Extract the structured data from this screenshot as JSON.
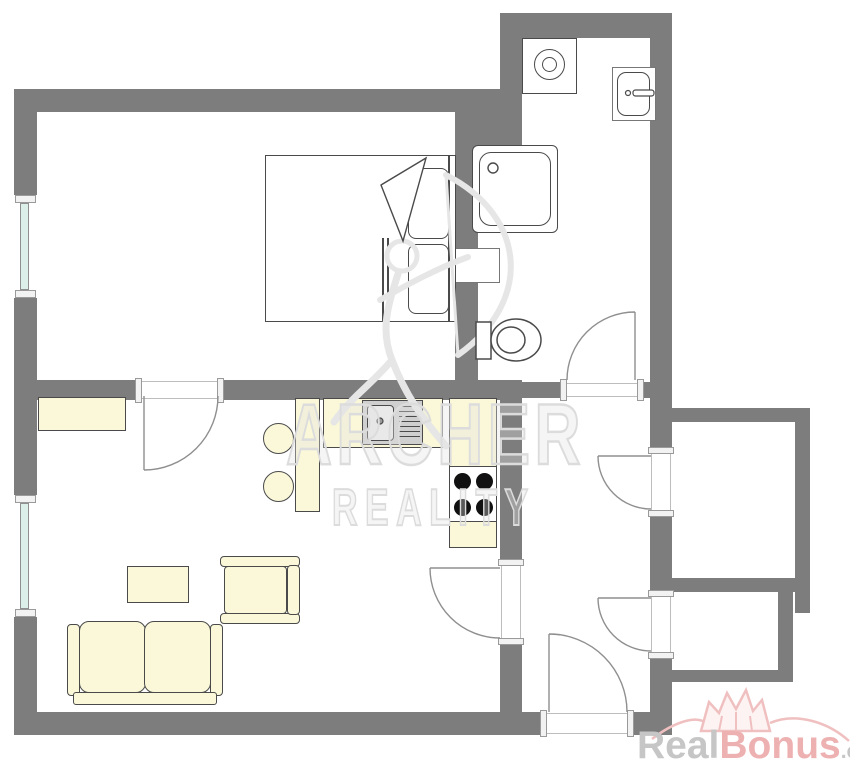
{
  "meta": {
    "kind": "real-estate floor plan",
    "width_px": 850,
    "height_px": 768
  },
  "colors": {
    "background": "#ffffff",
    "wall": "#7d7d7d",
    "furniture_fill": "#faf8d8",
    "outline": "#4a4a4a",
    "door_arc": "#8f8f8f",
    "window_glass": "#dcefe9",
    "sink_gray": "#cfcfcf",
    "burner_black": "#111111",
    "watermark_gray": "#dcdcdc",
    "logo_gray": "#c6c6c6",
    "logo_pink": "#eeb1b1"
  },
  "watermark": {
    "line1": "ARCHER",
    "line2": "REALITY"
  },
  "logo": {
    "part1": "Real",
    "part2": "Bonus",
    "part3": ".cz"
  },
  "fixtures": [
    "washing-machine",
    "bathroom-sink",
    "shower",
    "toilet",
    "wall-niche",
    "double-bed",
    "pillows",
    "blanket-fold",
    "kitchen-sink-with-drainboard",
    "stove-four-burners",
    "bar-counter",
    "bar-stools",
    "cabinet",
    "coffee-table",
    "armchair",
    "sofa",
    "windows-left-wall",
    "interior-doors",
    "entrance-door"
  ]
}
